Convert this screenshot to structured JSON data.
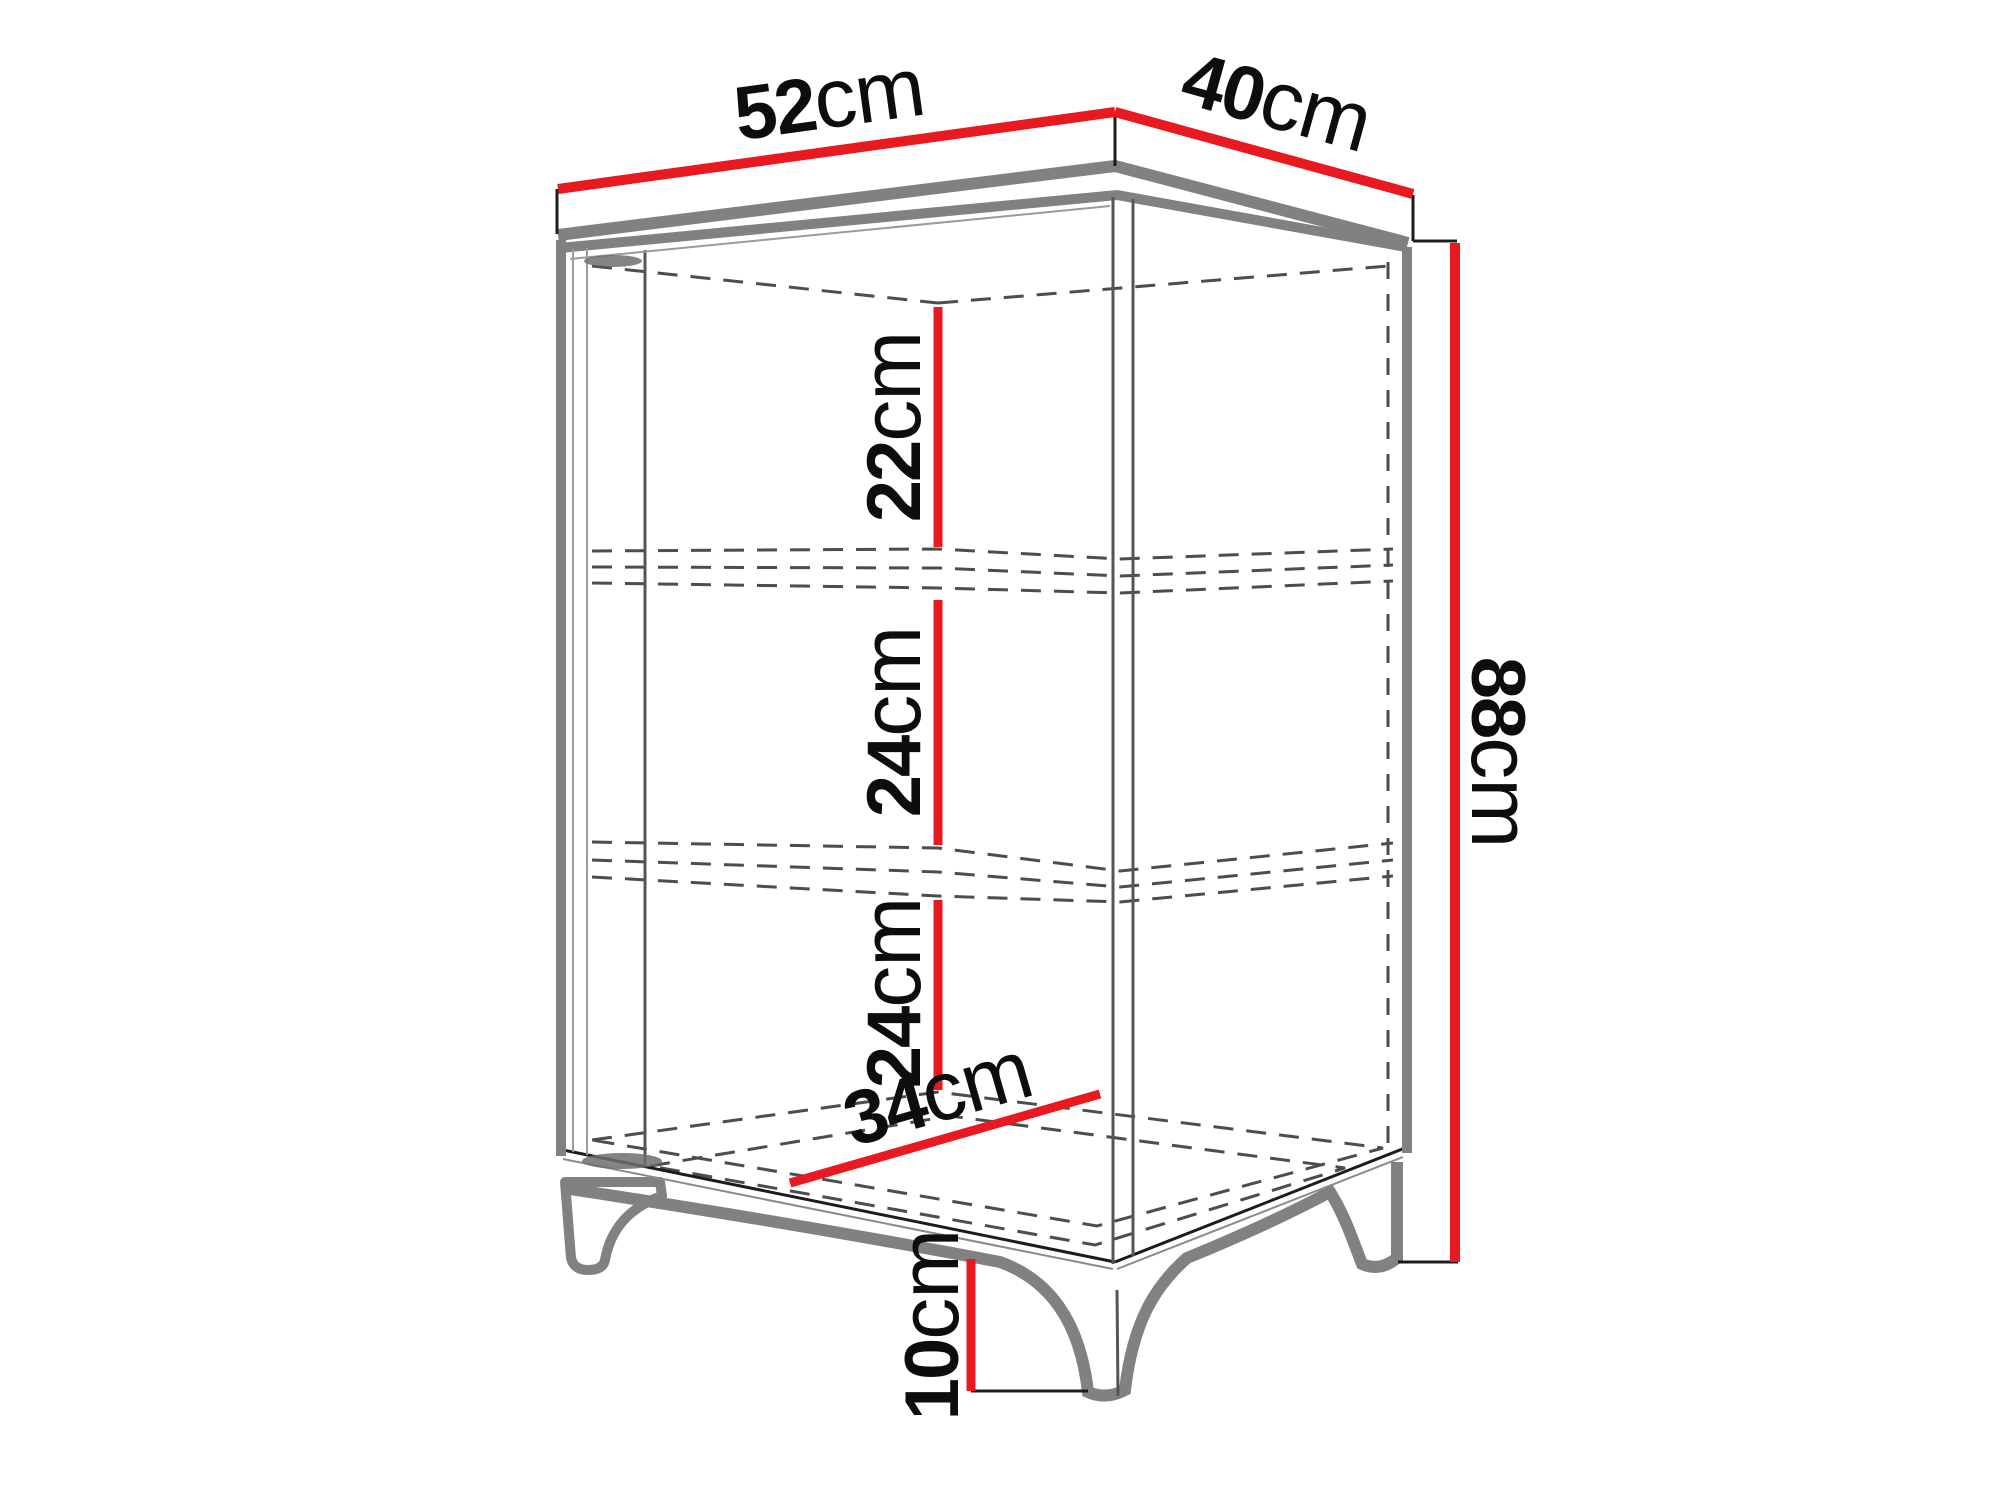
{
  "diagram": {
    "title": "cabinet-dimension-drawing",
    "object": "two-door corner display cabinet with two shelves and four curved legs",
    "dimensions": {
      "top_width": {
        "num": "52",
        "unit": "cm",
        "meaning": "top panel width (left edge)"
      },
      "top_depth": {
        "num": "40",
        "unit": "cm",
        "meaning": "top panel depth (right edge)"
      },
      "total_height": {
        "num": "88",
        "unit": "cm",
        "meaning": "overall cabinet height"
      },
      "compartment_top": {
        "num": "22",
        "unit": "cm",
        "meaning": "top compartment interior height"
      },
      "compartment_middle": {
        "num": "24",
        "unit": "cm",
        "meaning": "middle compartment interior height"
      },
      "compartment_bottom": {
        "num": "24",
        "unit": "cm",
        "meaning": "bottom compartment interior height"
      },
      "interior_depth": {
        "num": "34",
        "unit": "cm",
        "meaning": "interior bottom depth (diagonal on floor)"
      },
      "leg_height": {
        "num": "10",
        "unit": "cm",
        "meaning": "leg height"
      }
    },
    "colors": {
      "dimension_red": "#e8191f",
      "outline_gray": "#818181",
      "line_dark": "#1c1c1c",
      "dashed_gray": "#4d4d4d",
      "background": "#ffffff"
    }
  }
}
